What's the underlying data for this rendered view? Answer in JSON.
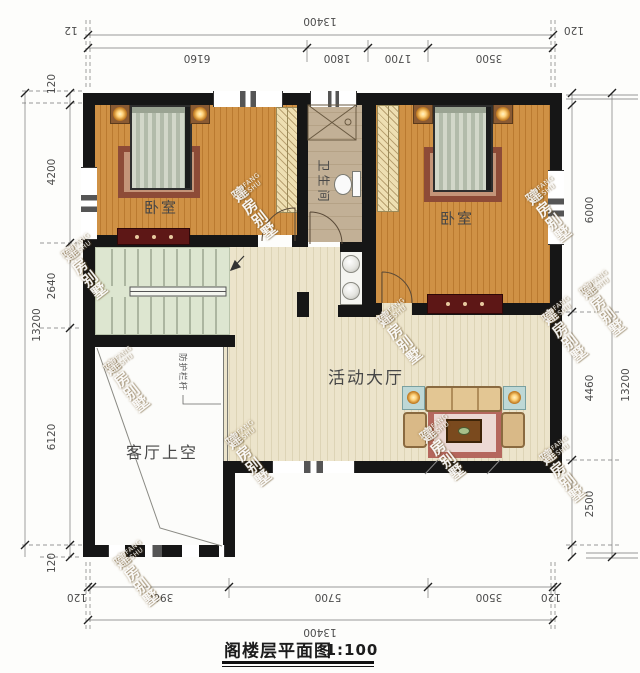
{
  "caption": {
    "title": "阁楼层平面图",
    "scale": "1:100"
  },
  "watermark": {
    "cn": "建房别墅",
    "en": "JIANFANG BIESHU"
  },
  "rooms": {
    "bedroom_left": {
      "label": "卧室"
    },
    "bedroom_right": {
      "label": "卧室"
    },
    "bathroom": {
      "label": "卫生间"
    },
    "hall": {
      "label": "活动大厅"
    },
    "void": {
      "label": "客厅上空"
    },
    "railing_note": {
      "label": "防护栏杆"
    }
  },
  "dimensions": {
    "top": {
      "overall": "13400",
      "left_end": "12",
      "right_end": "120",
      "segments": [
        "6160",
        "1800",
        "1700",
        "3500"
      ]
    },
    "bottom": {
      "overall": "13400",
      "segments": [
        "120",
        "3960",
        "5700",
        "3500",
        "120"
      ]
    },
    "left": {
      "overall": "13200",
      "segments": [
        "120",
        "4200",
        "2640",
        "6120",
        "120"
      ]
    },
    "right": {
      "overall": "13200",
      "segments": [
        "6000",
        "4460",
        "2500"
      ]
    }
  },
  "colors": {
    "wall": "#161616",
    "bedroomFloor": "#c98a3d",
    "bathFloor": "#c2b096",
    "stairsFloor": "#dde6d0",
    "hallFloor": "#eae2c8",
    "voidFloor": "#fcfcfa"
  }
}
